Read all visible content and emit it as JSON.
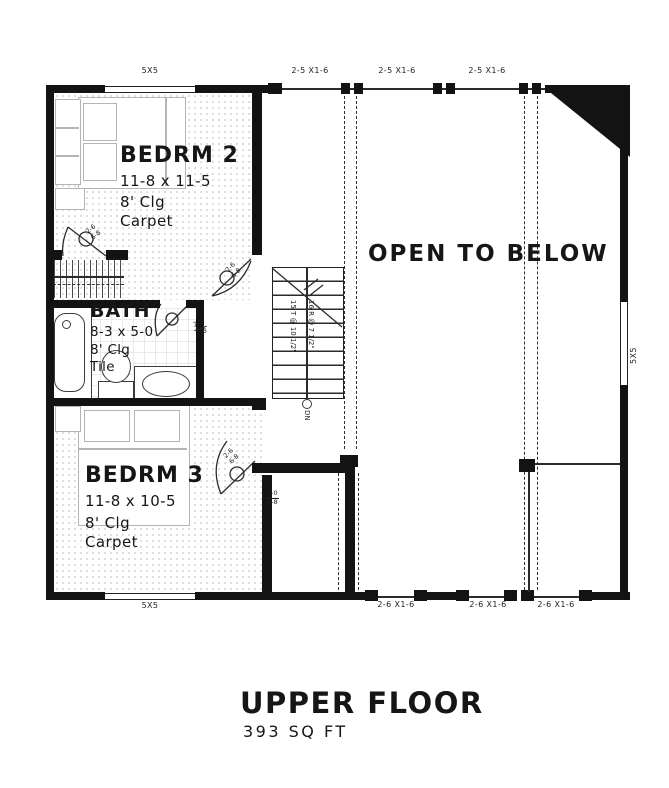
{
  "plan": {
    "title": "UPPER FLOOR",
    "subtitle": "393 SQ FT",
    "open_label": "OPEN TO BELOW",
    "rooms": {
      "bedrm2": {
        "name": "BEDRM 2",
        "dims": "11-8 x 11-5",
        "clg": "8' Clg",
        "floor": "Carpet"
      },
      "bath": {
        "name": "BATH",
        "dims": "8-3 x 5-0",
        "clg": "8' Clg",
        "floor": "Tile"
      },
      "bedrm3": {
        "name": "BEDRM 3",
        "dims": "11-8 x 10-5",
        "clg": "8' Clg",
        "floor": "Carpet"
      }
    },
    "stairs": {
      "treads": "15 T @ 10 1/2\"",
      "risers": "16 R @ 7 1/2\"",
      "down": "DN"
    },
    "windows": {
      "top_left": "5X5",
      "bottom_left": "5X5",
      "right": "5X5",
      "top": [
        "2-5 X1-6",
        "2-5 X1-6",
        "2-5 X1-6"
      ],
      "bottom": [
        "2-6 X1-6",
        "2-6 X1-6",
        "2-6 X1-6"
      ]
    },
    "door_labels": {
      "bedrm2_w": "2-6",
      "bedrm2_h": "6-8",
      "closet_w": "2-6",
      "closet_h": "6-8",
      "bath_top": "2-0",
      "bath_bottom": "2-8",
      "bedrm3_w": "2-6",
      "bedrm3_h": "6-8",
      "opening_top": "7-0",
      "opening_bottom": "2-8"
    },
    "colors": {
      "wall": "#131313",
      "line": "#2b2b2b",
      "furniture": "#b4b4b4",
      "text": "#161616"
    }
  }
}
